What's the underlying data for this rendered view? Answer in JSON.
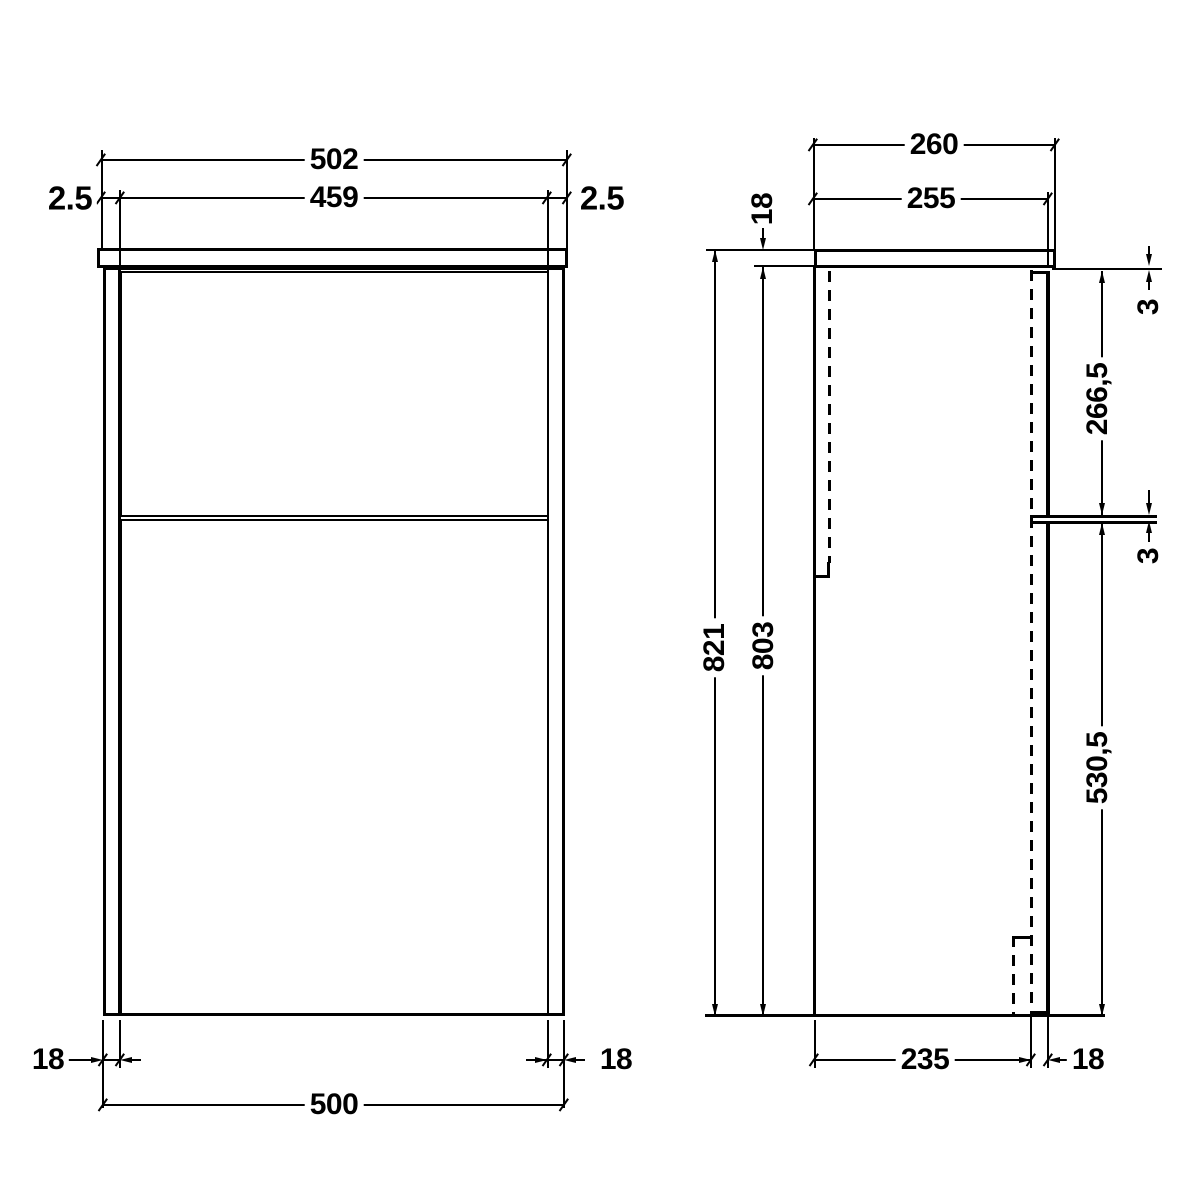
{
  "front": {
    "overall_width": "502",
    "door_width": "459",
    "gap_left": "2.5",
    "gap_right": "2.5",
    "side_left": "18",
    "side_right": "18",
    "carcass_width": "500"
  },
  "side": {
    "overall_depth": "260",
    "carcass_depth": "255",
    "worktop_thickness": "18",
    "overall_height": "821",
    "carcass_height": "803",
    "top_gap": "3",
    "upper_door_height": "266,5",
    "mid_gap": "3",
    "lower_door_height": "530,5",
    "base_depth": "235",
    "door_thickness": "18"
  },
  "colors": {
    "line": "#000000",
    "background": "#ffffff"
  }
}
